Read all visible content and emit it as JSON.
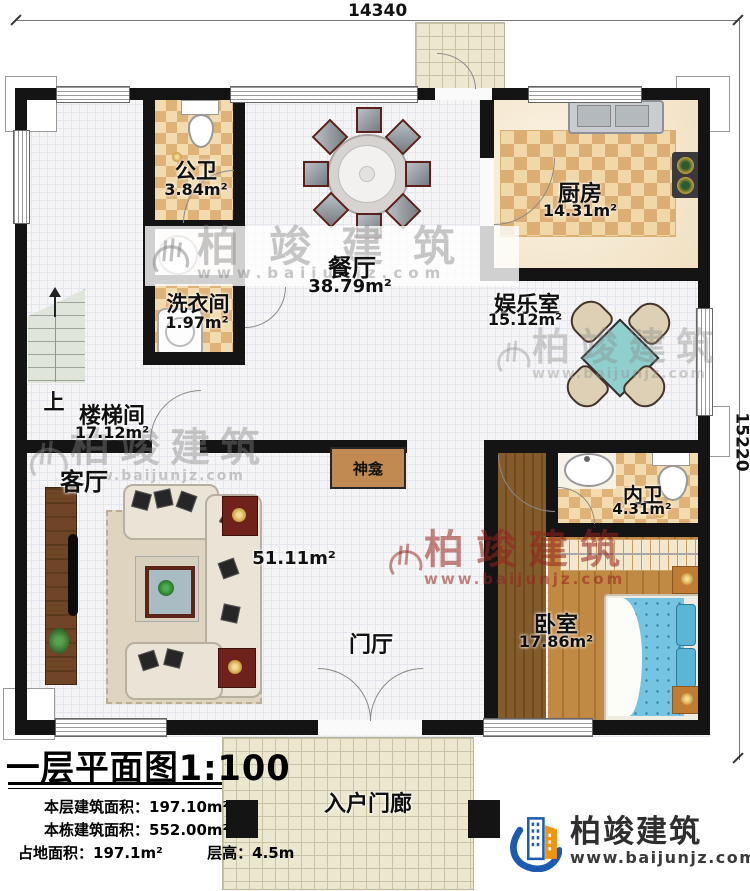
{
  "dimensions": {
    "width_mm": "14340",
    "height_mm": "15220"
  },
  "rooms": {
    "gongwei": {
      "name": "公卫",
      "area": "3.84m²"
    },
    "xiyijian": {
      "name": "洗衣间",
      "area": "1.97m²"
    },
    "canting": {
      "name": "餐厅",
      "area": "38.79m²"
    },
    "chufang": {
      "name": "厨房",
      "area": "14.31m²"
    },
    "yuleshi": {
      "name": "娱乐室",
      "area": "15.12m²"
    },
    "loutijian": {
      "name": "楼梯间",
      "area": "17.12m²"
    },
    "keting": {
      "name": "客厅",
      "area": "51.11m²"
    },
    "neiwei": {
      "name": "内卫",
      "area": "4.31m²"
    },
    "woshi": {
      "name": "卧室",
      "area": "17.86m²"
    },
    "menting": {
      "name": "门厅"
    },
    "shenkan": {
      "name": "神龛"
    },
    "rumenlang": {
      "name": "入户门廊"
    }
  },
  "stairs_label": "上",
  "title_block": {
    "title": "一层平面图1:100",
    "line1_label": "本层建筑面积：",
    "line1_value": "197.10m²",
    "line2_label": "本栋建筑面积：",
    "line2_value": "552.00m²",
    "line3a_label": "占地面积：",
    "line3a_value": "197.1m²",
    "line3b_label": "层高：",
    "line3b_value": "4.5m"
  },
  "brand": {
    "name": "柏竣建筑",
    "url": "www.baijunjz.com"
  },
  "watermark": {
    "name": "柏竣建筑",
    "url": "www.baijunjz.com"
  },
  "colors": {
    "wall": "#141414",
    "tile_light": "#f2dcaf",
    "tile_dark": "#dfb277",
    "wood_floor": "#c08a44",
    "dark_wood": "#845b2b",
    "teal_table": "#8fd0ce",
    "bed_blue": "#74c4e2",
    "brand_blue": "#1d5bb0",
    "brand_orange": "#f0930f",
    "watermark_red": "#96211c",
    "watermark_gray": "#828282"
  }
}
